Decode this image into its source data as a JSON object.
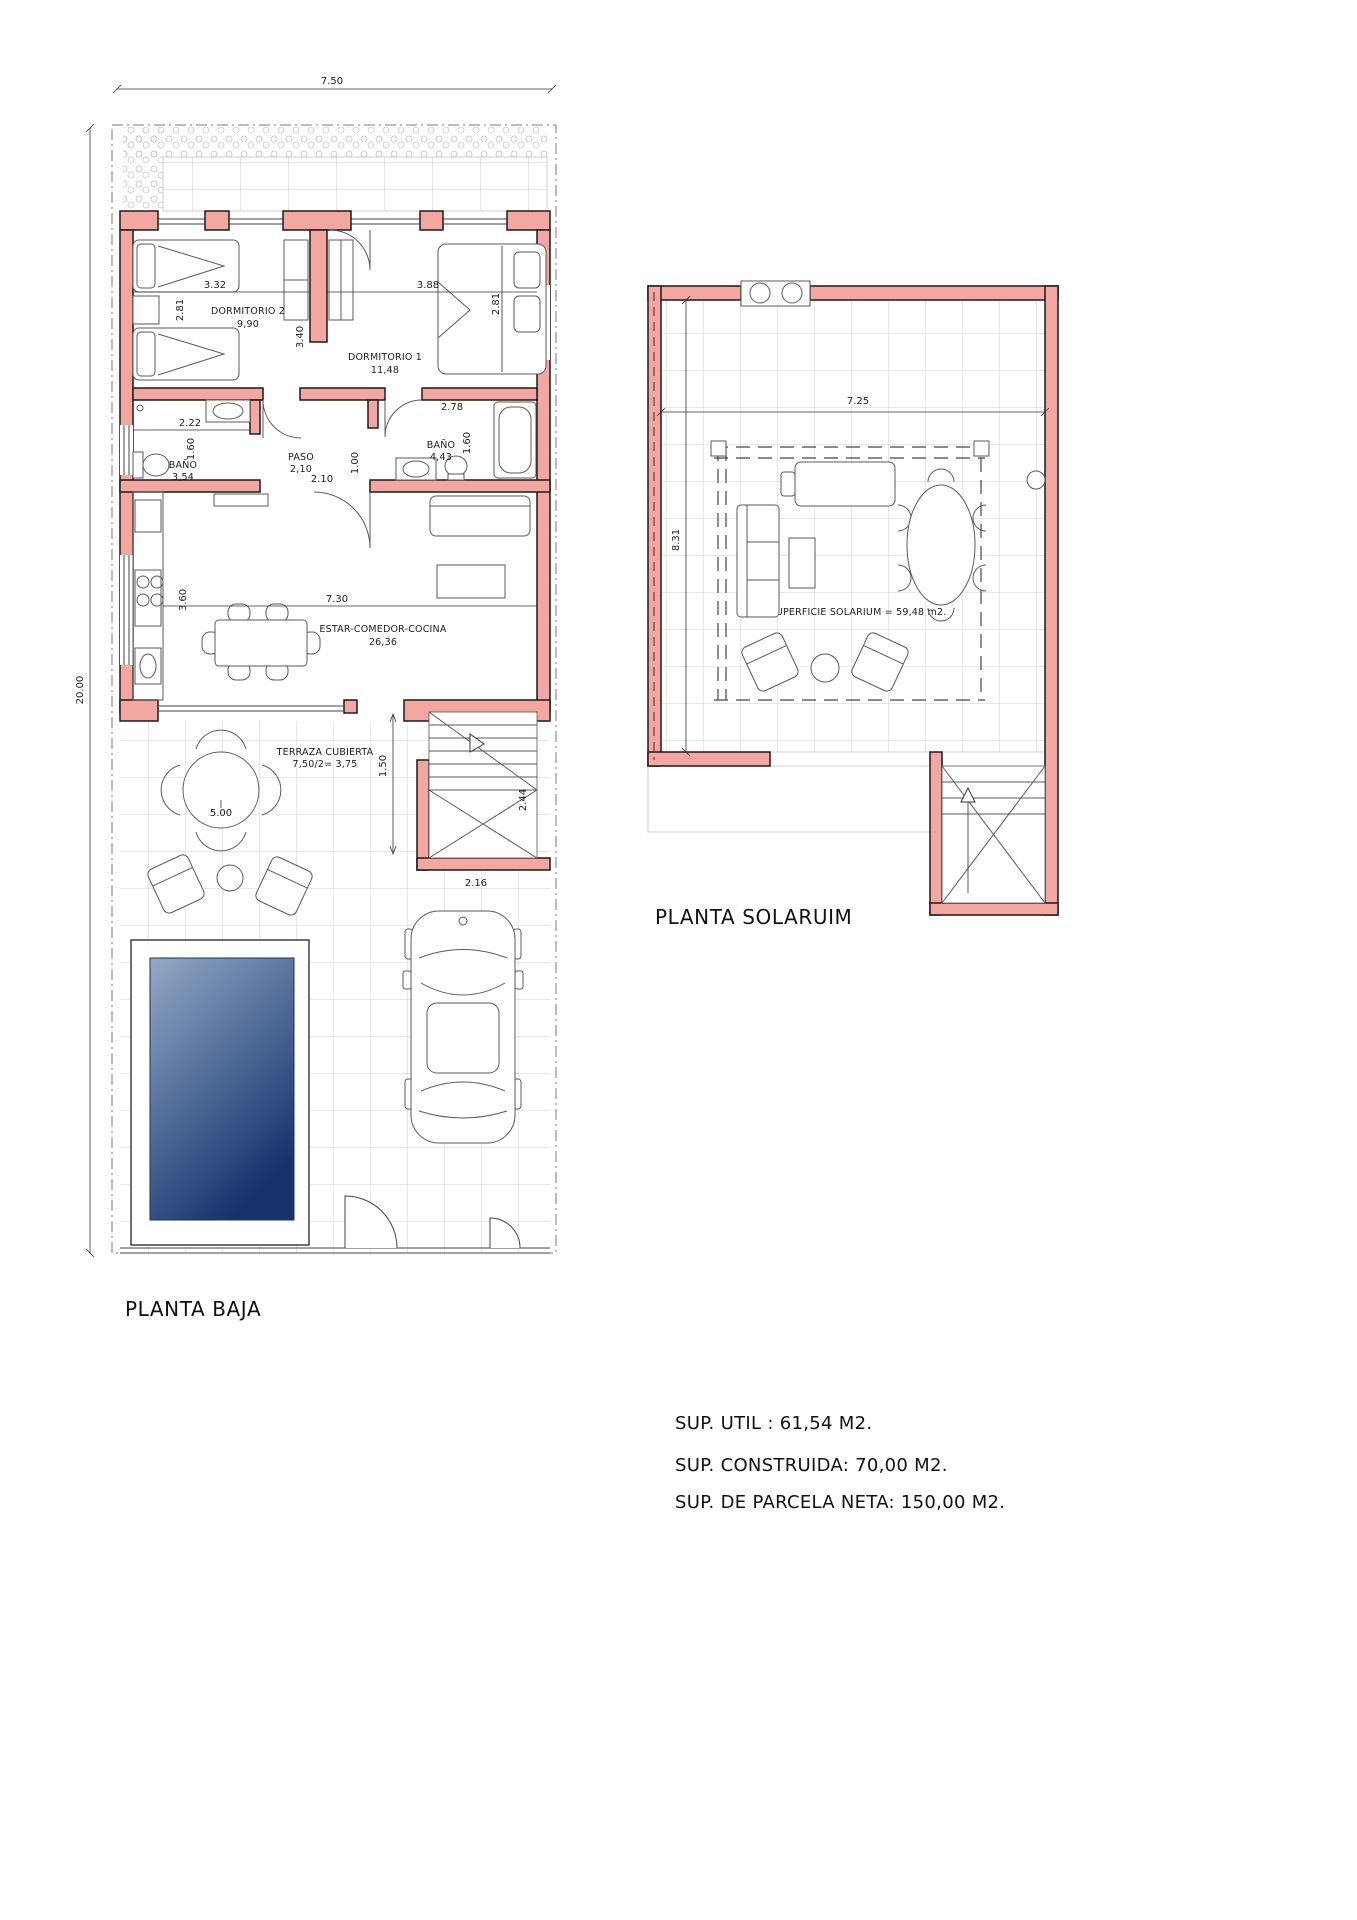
{
  "planta_baja": {
    "title": "PLANTA BAJA",
    "dim_top": "7.50",
    "dim_left": "20.00",
    "dormitorio2_label": "DORMITORIO 2",
    "dormitorio2_area": "9,90",
    "dormitorio2_dim_w": "3.32",
    "dormitorio2_dim_h": "2.81",
    "dorm_wall_dim": "3.40",
    "dormitorio1_label": "DORMITORIO 1",
    "dormitorio1_area": "11,48",
    "dormitorio1_dim_w": "3.88",
    "dormitorio1_dim_h": "2.81",
    "bano1_label": "BAÑO",
    "bano1_area": "3,54",
    "bano1_dim_w": "2.22",
    "bano1_dim_h": "1.60",
    "paso_label": "PASO",
    "paso_area": "2,10",
    "paso_dim_w": "2.10",
    "paso_dim_h": "1.00",
    "bano2_label": "BAÑO",
    "bano2_area": "4,43",
    "bano2_dim_w": "2.78",
    "bano2_dim_h": "1.60",
    "estar_label": "ESTAR-COMEDOR-COCINA",
    "estar_area": "26,36",
    "estar_dim_w": "7.30",
    "estar_dim_h": "3.60",
    "terraza_label": "TERRAZA CUBIERTA",
    "terraza_area": "7,50/2= 3,75",
    "terraza_dim_w": "5.00",
    "terraza_dim_h": "1.50",
    "stairs_dim_h": "2.44",
    "stairs_dim_w": "2.16"
  },
  "planta_solarium": {
    "title": "PLANTA SOLARUIM",
    "dim_top": "7.25",
    "dim_left": "8.31",
    "surface_label": "SUPERFICIE SOLARIUM = 59,48 m2."
  },
  "summary": {
    "line1": "SUP. UTIL : 61,54 M2.",
    "line2": "SUP. CONSTRUIDA: 70,00 M2.",
    "line3": "SUP. DE PARCELA NETA: 150,00 M2."
  },
  "colors": {
    "wall": "#F4A7A1",
    "pool_light": "#93A9C6",
    "pool_dark": "#16336E"
  }
}
